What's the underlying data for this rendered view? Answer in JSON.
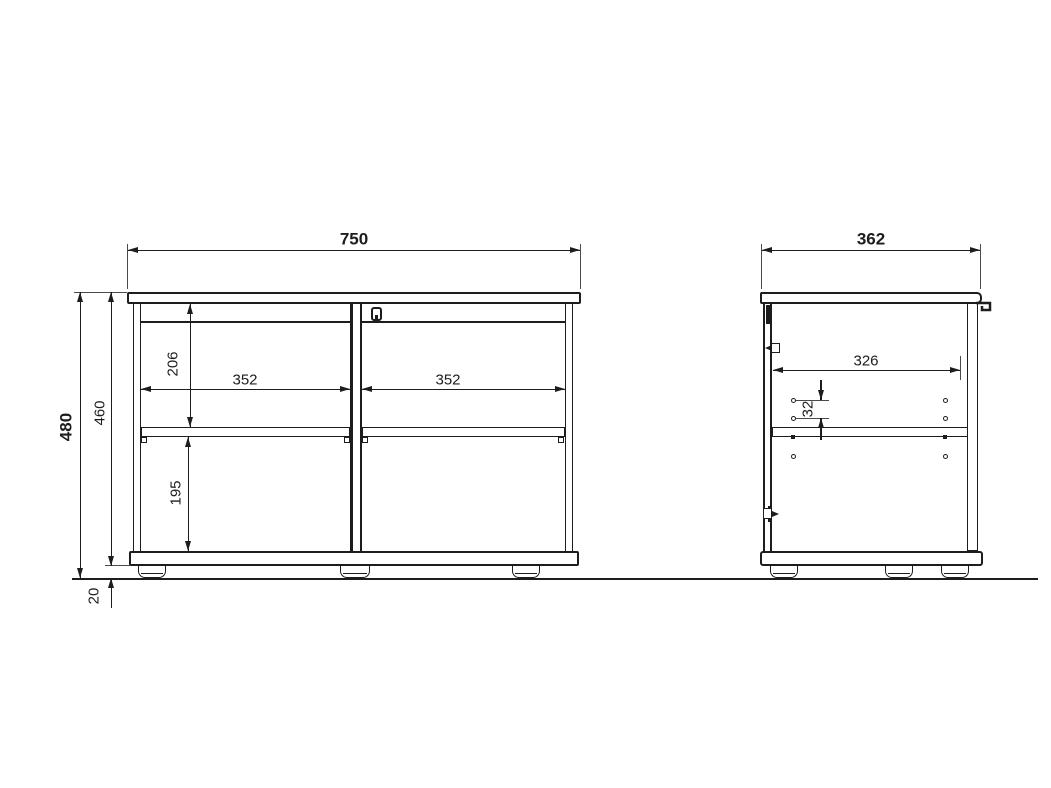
{
  "drawing": {
    "front_view": {
      "overall_width": "750",
      "overall_height": "480",
      "body_height": "460",
      "upper_compartment_height": "206",
      "lower_compartment_height": "195",
      "left_opening_width": "352",
      "right_opening_width": "352",
      "foot_height": "20"
    },
    "side_view": {
      "overall_depth": "362",
      "inner_depth": "326",
      "shelf_hole_spacing": "32"
    },
    "colors": {
      "line": "#1d1d1b",
      "background": "#ffffff"
    }
  }
}
